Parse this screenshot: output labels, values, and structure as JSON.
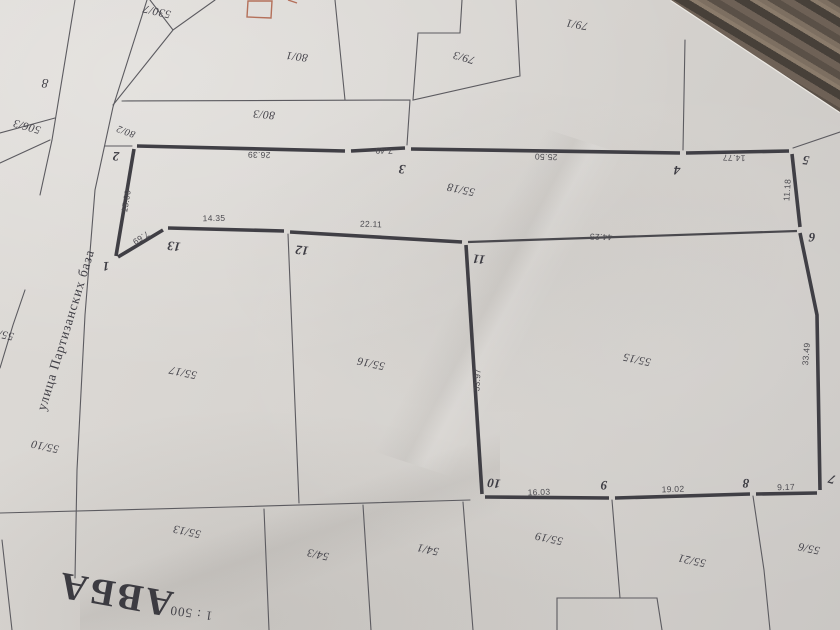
{
  "drawing": {
    "street_name": "улица Партизанских база",
    "title_fragment": "АВБА",
    "scale_label": "1 : 500",
    "points": {
      "p1": "1",
      "p2": "2",
      "p3": "3",
      "p4": "4",
      "p5": "5",
      "p6": "6",
      "p7": "7",
      "p8": "8",
      "p9": "9",
      "p10": "10",
      "p11": "11",
      "p12": "12",
      "p13": "13"
    },
    "dimensions": {
      "d_1_2": "15.00",
      "d_1_13": "7.69",
      "d_13_12": "14.35",
      "d_12_11": "22.11",
      "d_2_3": "26.39",
      "d_3a_3": "7.49",
      "d_3_4": "25.50",
      "d_4_5": "14.77",
      "d_5_6": "11.18",
      "d_11_6": "44.25",
      "d_11_10": "33.97",
      "d_10_9": "16.03",
      "d_9_8": "19.02",
      "d_8_7": "9.17",
      "d_7_6": "33.49"
    },
    "parcels": {
      "p530_7": "530/7",
      "p8": "8",
      "p506_3": "506/3",
      "p80_2": "80/2",
      "p80_3": "80/3",
      "p80_1": "80/1",
      "p79_3": "79/3",
      "p79_1": "79/1",
      "p55_18": "55/18",
      "p55_17": "55/17",
      "p55_16": "55/16",
      "p55_15": "55/15",
      "p55_10": "55/10",
      "p55_1": "55/1",
      "p55_13": "55/13",
      "p54_3": "54/3",
      "p54_1": "54/1",
      "p55_19": "55/19",
      "p55_21": "55/21",
      "p55_6": "55/6"
    },
    "colors": {
      "paper": "#d8d5d1",
      "ink": "#46454a",
      "boundary": "#403f45",
      "red_outline": "#b4705a",
      "table_wood": "#5a5047"
    }
  }
}
